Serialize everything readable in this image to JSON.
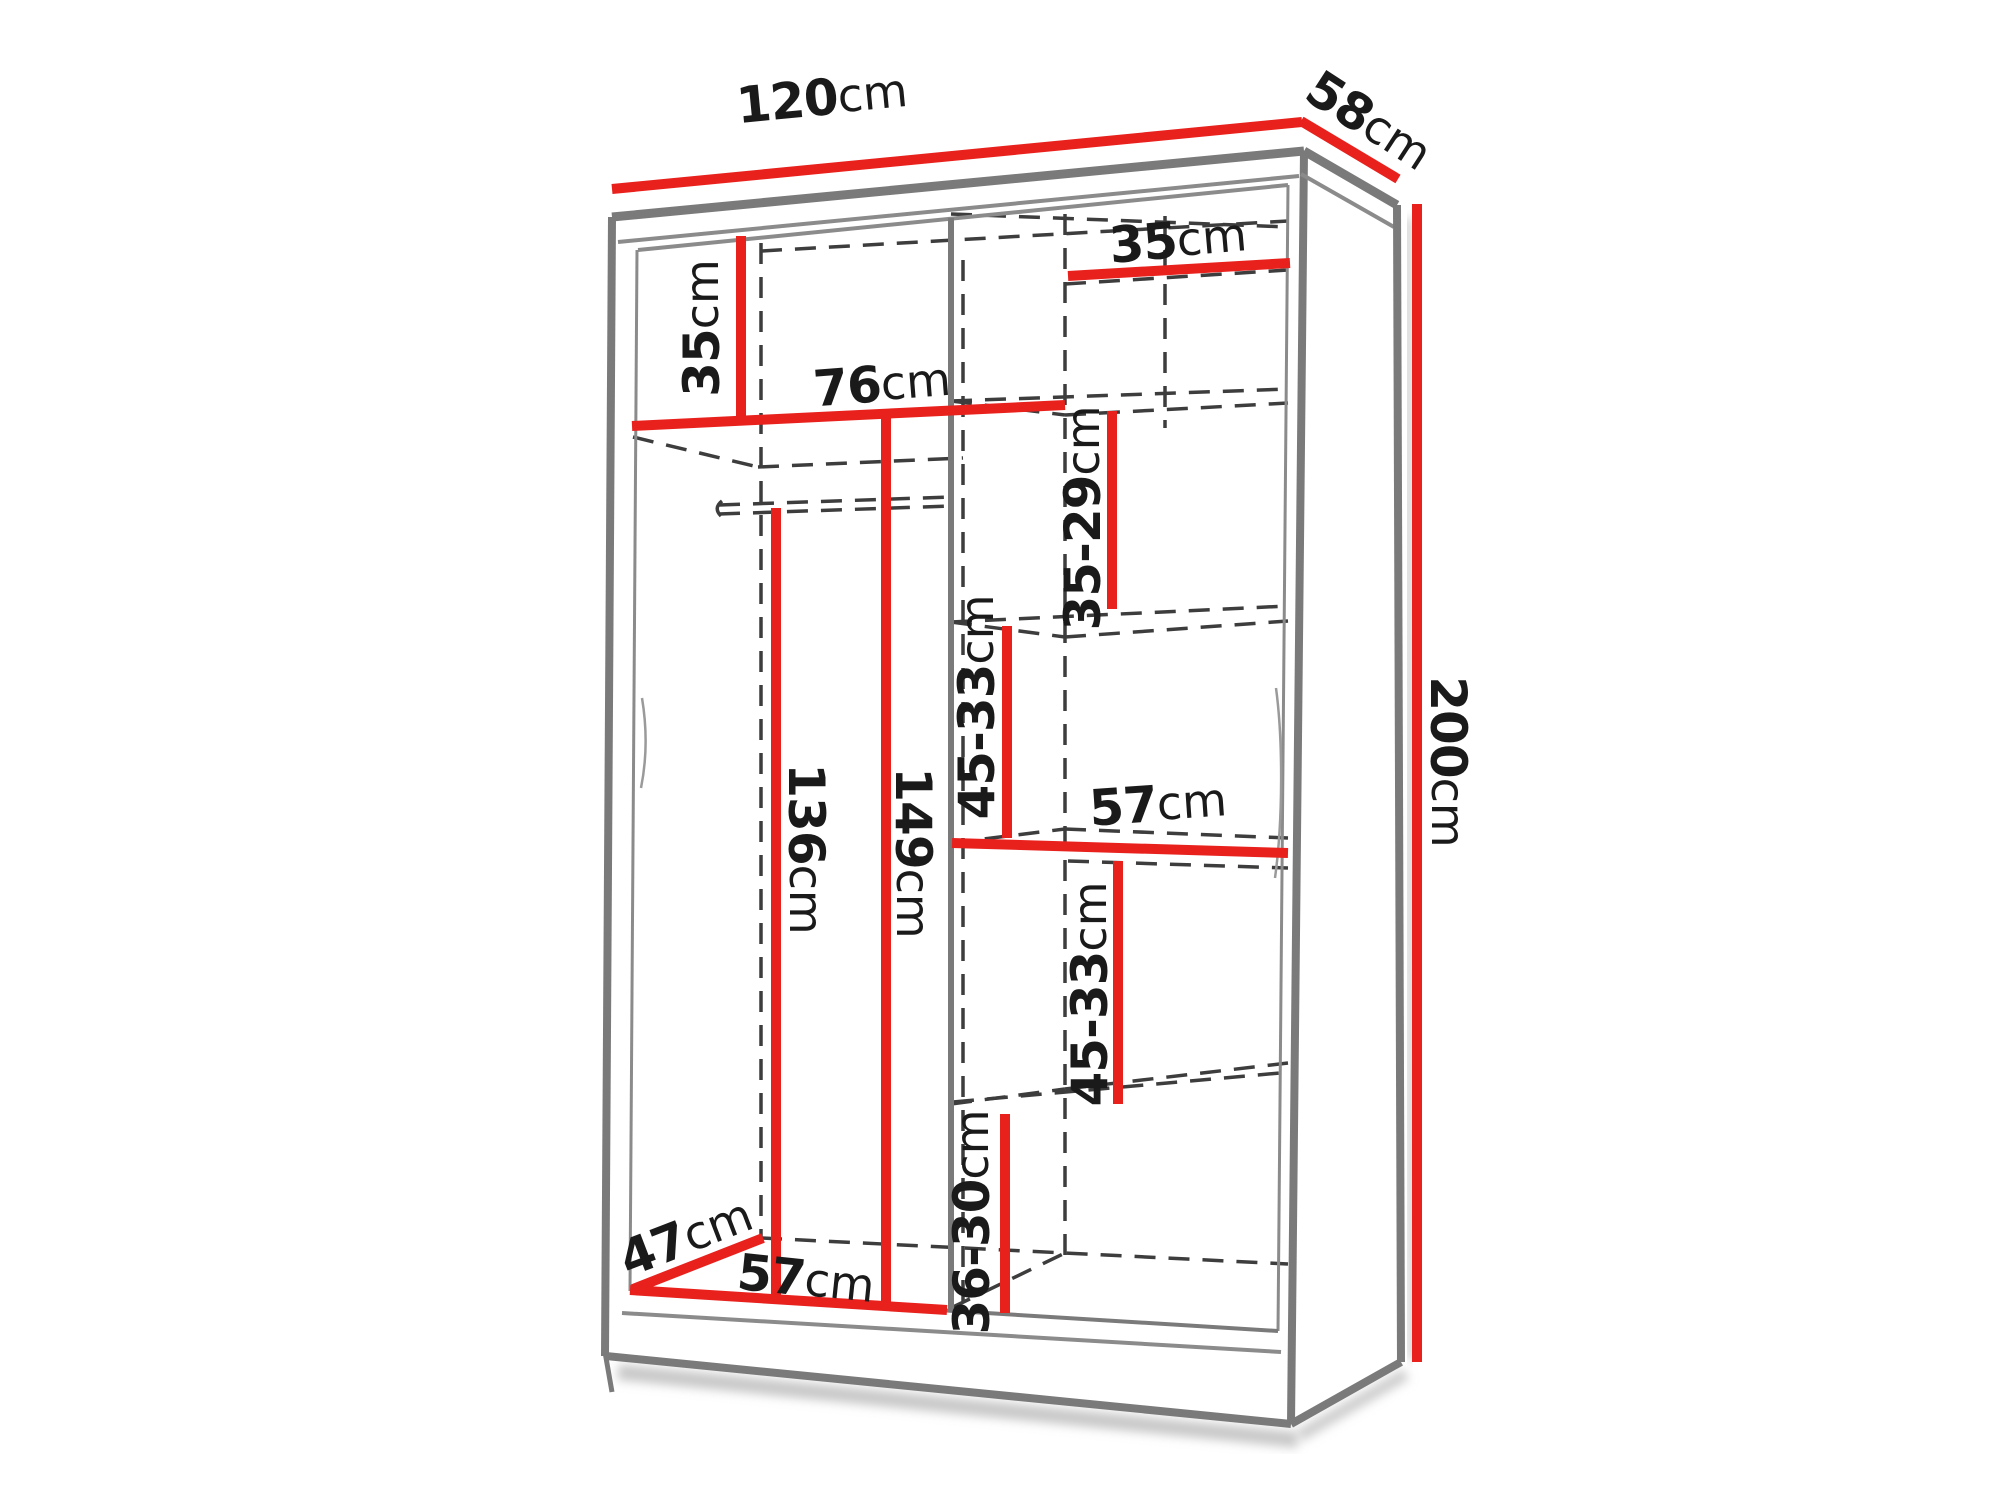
{
  "diagram": {
    "kind": "wardrobe-dimension-drawing",
    "colors": {
      "dimension_line": "#e8211d",
      "outline": "#7a7a7a",
      "hidden_line": "#3d3d3d",
      "label_text": "#1a1a1a",
      "background": "#ffffff"
    },
    "dims": {
      "width": {
        "value": "120",
        "unit": "cm"
      },
      "depth": {
        "value": "58",
        "unit": "cm"
      },
      "height": {
        "value": "200",
        "unit": "cm"
      },
      "top_right_width": {
        "value": "35",
        "unit": "cm"
      },
      "top_left_height": {
        "value": "35",
        "unit": "cm"
      },
      "left_shelf_width": {
        "value": "76",
        "unit": "cm"
      },
      "right_gap_top": {
        "value": "35-29",
        "unit": "cm"
      },
      "right_gap_upper": {
        "value": "45-33",
        "unit": "cm"
      },
      "right_shelf_width": {
        "value": "57",
        "unit": "cm"
      },
      "right_gap_lower": {
        "value": "45-33",
        "unit": "cm"
      },
      "hanging_rod_height": {
        "value": "136",
        "unit": "cm"
      },
      "hanging_shelf_height": {
        "value": "149",
        "unit": "cm"
      },
      "bottom_depth": {
        "value": "47",
        "unit": "cm"
      },
      "bottom_width": {
        "value": "57",
        "unit": "cm"
      },
      "right_gap_bottom": {
        "value": "36-30",
        "unit": "cm"
      }
    }
  }
}
